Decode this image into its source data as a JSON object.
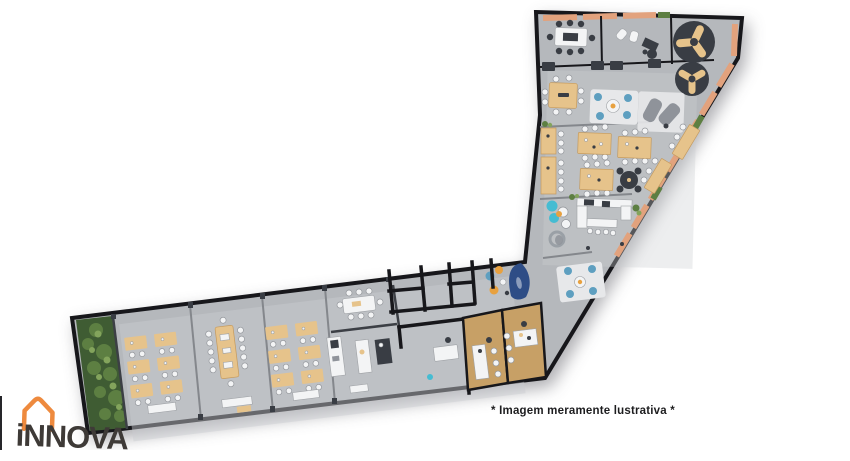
{
  "caption": {
    "text": "* Imagem meramente lustrativa *"
  },
  "logo": {
    "text": "iNNOVA"
  },
  "colors": {
    "background": "#ffffff",
    "floor": "#b5b8bc",
    "floor_light": "#cacdd0",
    "wall": "#17171b",
    "wood": "#e6c38b",
    "wood_dark": "#c49a5e",
    "wood_floor": "#c7a066",
    "bench_strip": "#e2a27d",
    "furniture_dark": "#393d44",
    "furniture_white": "#f3f4f5",
    "rug_white": "#e7e8ea",
    "plant_dark": "#3f5c33",
    "plant_mid": "#5d7f42",
    "plant_light": "#83a45c",
    "chair_blue": "#5e9fc0",
    "accent_teal": "#45bcd2",
    "accent_orange": "#e8a13f",
    "tent_blue": "#2e4d86",
    "lounge_gray": "#8f939a",
    "logo_orange": "#ee8a3e",
    "logo_text": "#3e3a37",
    "caption_color": "#1d1d1f"
  }
}
